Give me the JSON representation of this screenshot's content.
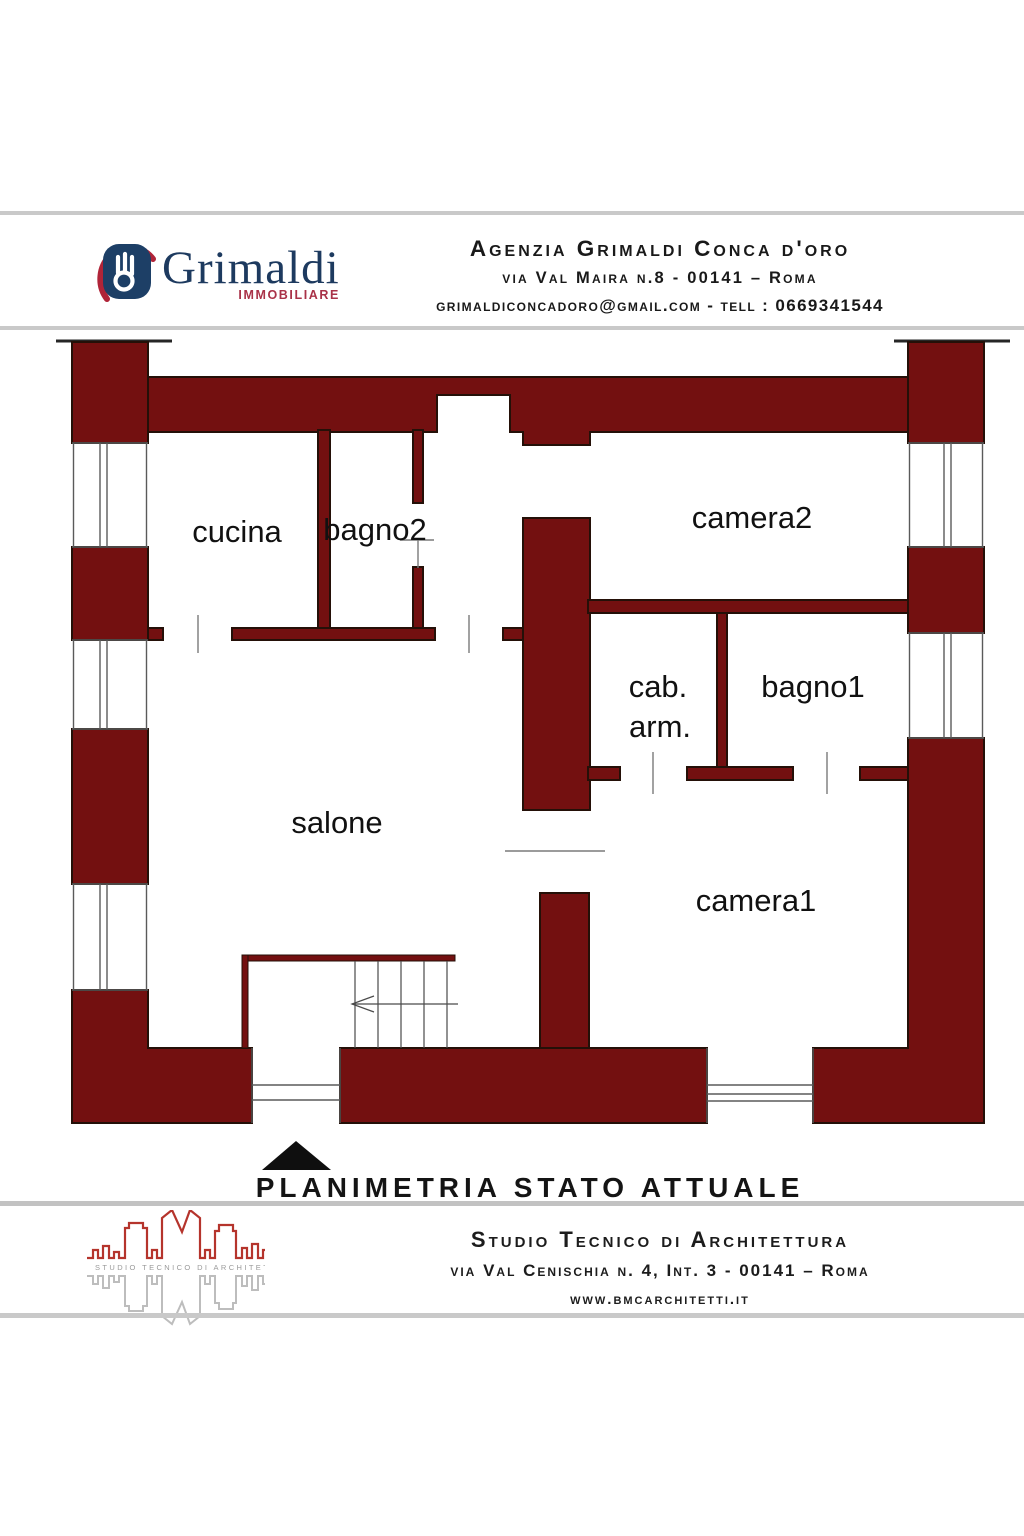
{
  "header": {
    "brand": "Grimaldi",
    "brand_sub": "IMMOBILIARE",
    "line1": "Agenzia Grimaldi Conca d'oro",
    "line2": "via Val Maira n.8  - 00141 – Roma",
    "line3": "grimaldiconcadoro@gmail.com - tell : 0669341544"
  },
  "plan": {
    "caption": "PLANIMETRIA STATO ATTUALE",
    "wall_color": "#731010",
    "rooms": [
      {
        "label": "cucina"
      },
      {
        "label": "bagno2"
      },
      {
        "label": "camera2"
      },
      {
        "label": "cab."
      },
      {
        "label": "arm."
      },
      {
        "label": "bagno1"
      },
      {
        "label": "salone"
      },
      {
        "label": "camera1"
      }
    ]
  },
  "footer": {
    "logo_caption": "STUDIO TECNICO DI ARCHITETTURA",
    "line1": "Studio Tecnico di Architettura",
    "line2": "via Val Cenischia n. 4, Int. 3 - 00141 – Roma",
    "line3": "www.bmcarchitetti.it"
  },
  "colors": {
    "wall": "#731010",
    "brand_navy": "#1d3a5f",
    "brand_red": "#a93248",
    "bmc_red": "#b5342c",
    "separator_gray": "#c9c9c9"
  }
}
